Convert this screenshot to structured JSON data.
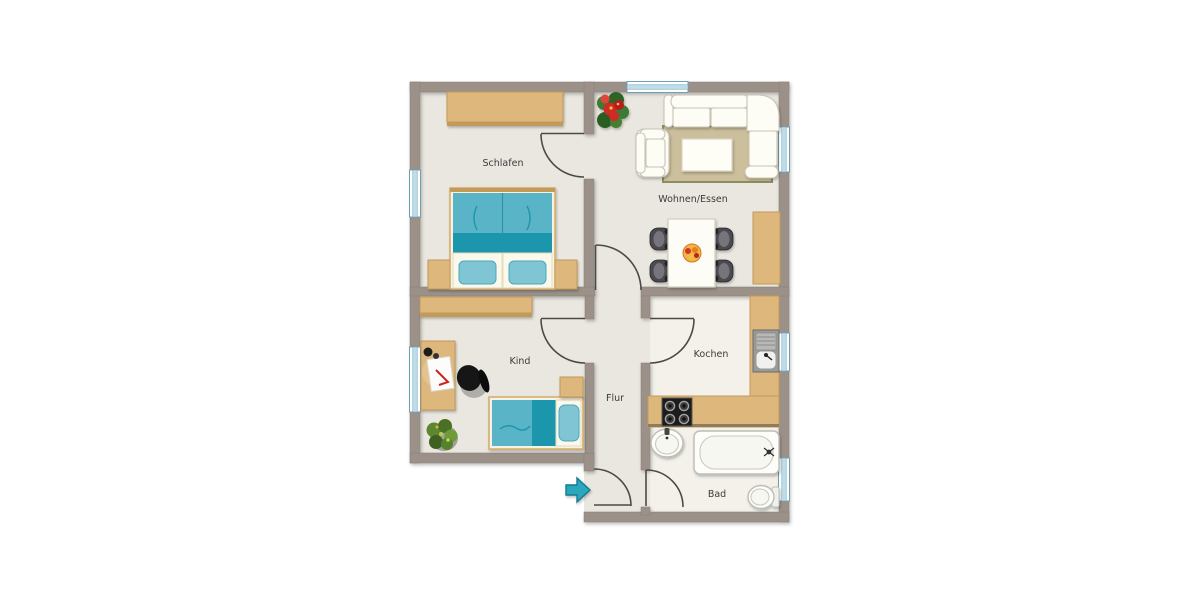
{
  "floorplan": {
    "type": "apartment-floor-plan",
    "rooms": [
      {
        "id": "schlafen",
        "label": "Schlafen",
        "furniture": [
          "wardrobe",
          "double-bed",
          "nightstand-left",
          "nightstand-right"
        ]
      },
      {
        "id": "wohnen_essen",
        "label": "Wohnen/Essen",
        "furniture": [
          "poinsettia-plant",
          "rug",
          "corner-sofa",
          "armchair",
          "coffee-table",
          "dining-table",
          "dining-chair",
          "dining-chair",
          "dining-chair",
          "dining-chair",
          "fruit-bowl",
          "sideboard"
        ]
      },
      {
        "id": "kind",
        "label": "Kind",
        "furniture": [
          "wardrobe",
          "desk",
          "desk-chair",
          "single-bed",
          "nightstand",
          "plant"
        ]
      },
      {
        "id": "flur",
        "label": "Flur",
        "furniture": [
          "entrance-arrow"
        ]
      },
      {
        "id": "kochen",
        "label": "Kochen",
        "furniture": [
          "counter-l-shape",
          "kitchen-sink",
          "stove"
        ]
      },
      {
        "id": "bad",
        "label": "Bad",
        "furniture": [
          "wash-basin",
          "bathtub",
          "toilet"
        ]
      }
    ],
    "windows": 6,
    "doors": 6,
    "entrance": {
      "icon": "entrance-arrow",
      "direction": "right"
    },
    "colors": {
      "wall": "#9b9189",
      "wall_edge": "#878078",
      "floor": "#eae7e0",
      "floor_light": "#f3f1ea",
      "wood": "#ddb77c",
      "wood_edge": "#c39a58",
      "teal": "#58b4c6",
      "teal_dark": "#1f96ac",
      "pillow": "#7fc5d3",
      "sofa": "#fdfcf5",
      "sofa_edge": "#c9c5b5",
      "window_frame": "#6f9fb4",
      "window_glass": "#bcdde9",
      "door": "#4c4a46",
      "label": "#3b3b3b",
      "arrow": "#2ba7bc",
      "arrow_edge": "#157a8d",
      "chair_dark": "#4b4b4f",
      "plant_green": "#55822c",
      "plant_red": "#cf2a25"
    }
  }
}
